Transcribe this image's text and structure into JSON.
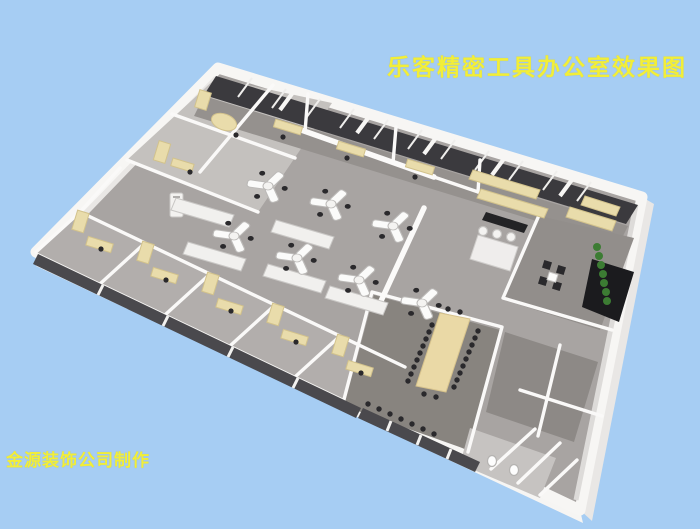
{
  "title": {
    "text": "乐客精密工具办公室效果图",
    "color": "#f2ee38"
  },
  "credit": {
    "text": "金源装饰公司制作",
    "color": "#f2ee38"
  },
  "colors": {
    "background": "#a6cdf3",
    "wall_white": "#f7f6f4",
    "floor_base": "#a8a4a2",
    "floor_light": "#c4c1be",
    "floor_dark": "#88847f",
    "window_glass": "#3b3a3e",
    "office_glass": "#4a494d",
    "furniture_beige": "#e9dcab",
    "conference_table": "#ead9a6",
    "desk_white": "#fbfbfa",
    "chair_black": "#2a292c",
    "plant_green": "#3c7c33"
  },
  "scene": {
    "label": "office-floor-plan-3d-rendering"
  }
}
